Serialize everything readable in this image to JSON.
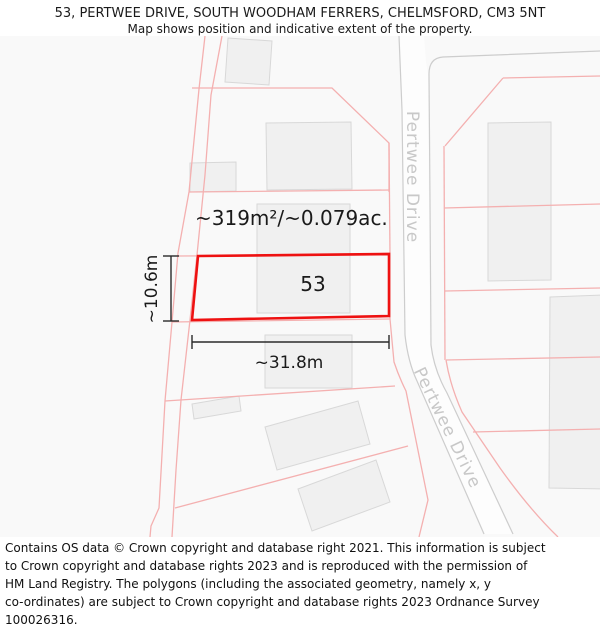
{
  "header": {
    "title": "53, PERTWEE DRIVE, SOUTH WOODHAM FERRERS, CHELMSFORD, CM3 5NT",
    "subtitle": "Map shows position and indicative extent of the property."
  },
  "map": {
    "plot_number": "53",
    "area_label": "~319m²/~0.079ac.",
    "width_label": "~31.8m",
    "height_label": "~10.6m",
    "road_labels": {
      "upper": "Pertwee Drive",
      "lower": "Pertwee Drive"
    },
    "colors": {
      "property_outline": "#ee1111",
      "parcel_line": "#f4b0b0",
      "building_fill": "#f0f0f0",
      "building_stroke": "#d8d8d8",
      "road_edge": "#cdcdcd",
      "road_label_text": "#c8c8c8",
      "dimension_line": "#2a2a2a",
      "map_background": "#f9f9f9"
    }
  },
  "footer": {
    "lines": [
      "Contains OS data © Crown copyright and database right 2021. This information is subject",
      "to Crown copyright and database rights 2023 and is reproduced with the permission of",
      "HM Land Registry. The polygons (including the associated geometry, namely x, y",
      "co-ordinates) are subject to Crown copyright and database rights 2023 Ordnance Survey",
      "100026316."
    ]
  }
}
